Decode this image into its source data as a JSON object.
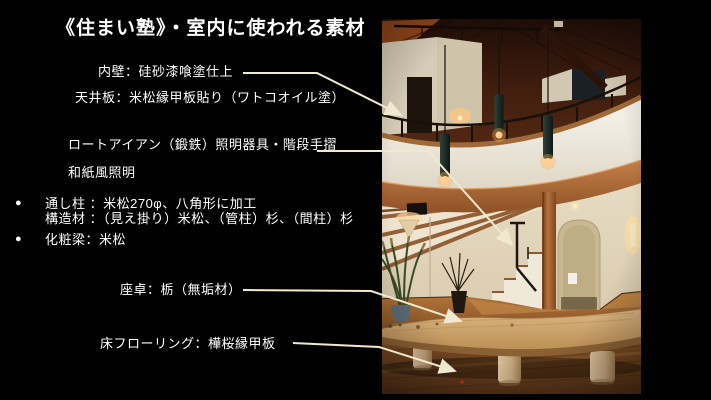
{
  "slide": {
    "title": "《住まい塾》・室内に使われる素材",
    "background_color": "#000000",
    "text_color": "#ffffff",
    "arrow_color": "#f0e8cf",
    "bullet_glyph": "●"
  },
  "annotations": {
    "inner_wall": "内壁：硅砂漆喰塗仕上",
    "ceiling_board": "天井板：米松縁甲板貼り（ワトコオイル塗）",
    "wrought_iron": "ロートアイアン（鍛鉄）照明器具・階段手摺",
    "washi_lighting": "和紙風照明",
    "through_post_line1": "通し柱 ：米松270φ、八角形に加工",
    "through_post_line2": "構造材 ：（見え掛り）米松、（管柱）杉、（間柱）杉",
    "decorative_beam": "化粧梁：米松",
    "low_table": "座卓：栃（無垢材）",
    "flooring": "床フローリング：樺桜縁甲板"
  }
}
